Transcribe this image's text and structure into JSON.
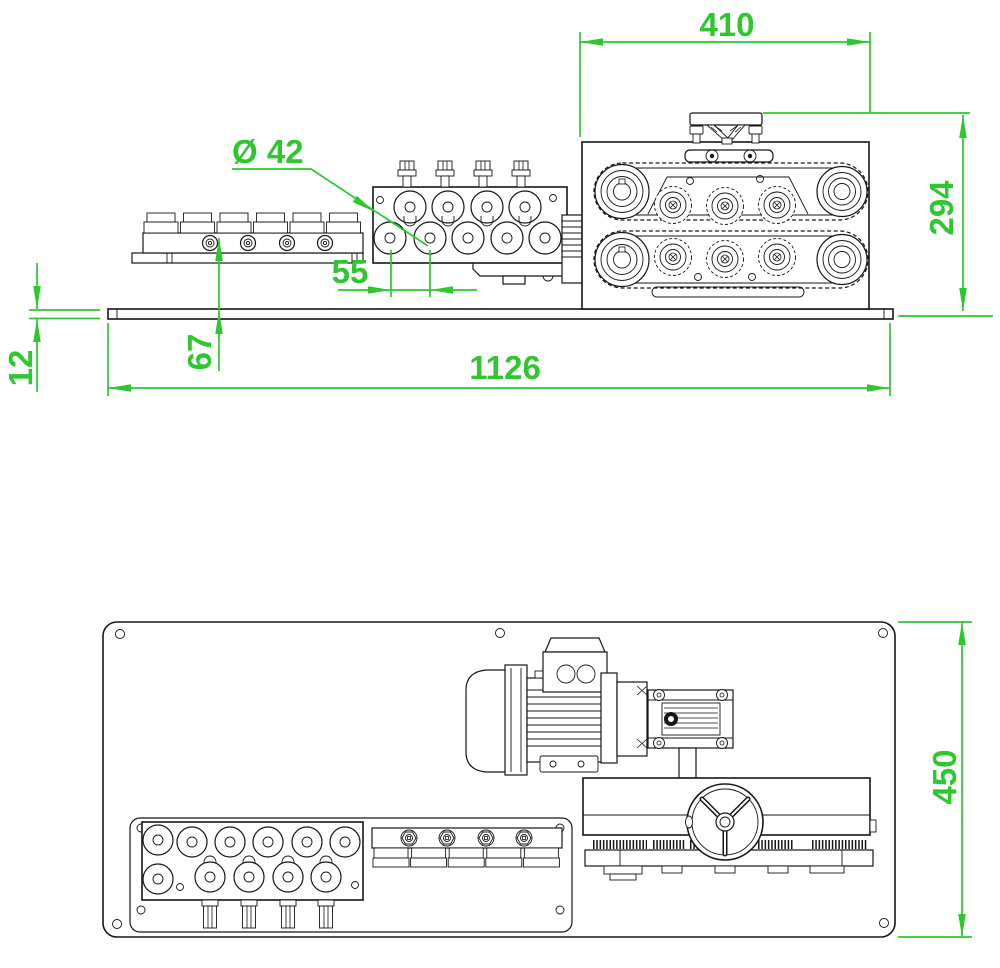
{
  "drawing": {
    "background_color": "#ffffff",
    "line_color": "#161616",
    "dimension_color": "#2ec82e",
    "dimensions": {
      "feeder_width": "410",
      "feeder_height": "294",
      "roller_diameter": "Ø 42",
      "roller_pitch": "55",
      "feed_line_height": "67",
      "plate_thickness": "12",
      "overall_length": "1126",
      "plate_depth": "450"
    }
  }
}
